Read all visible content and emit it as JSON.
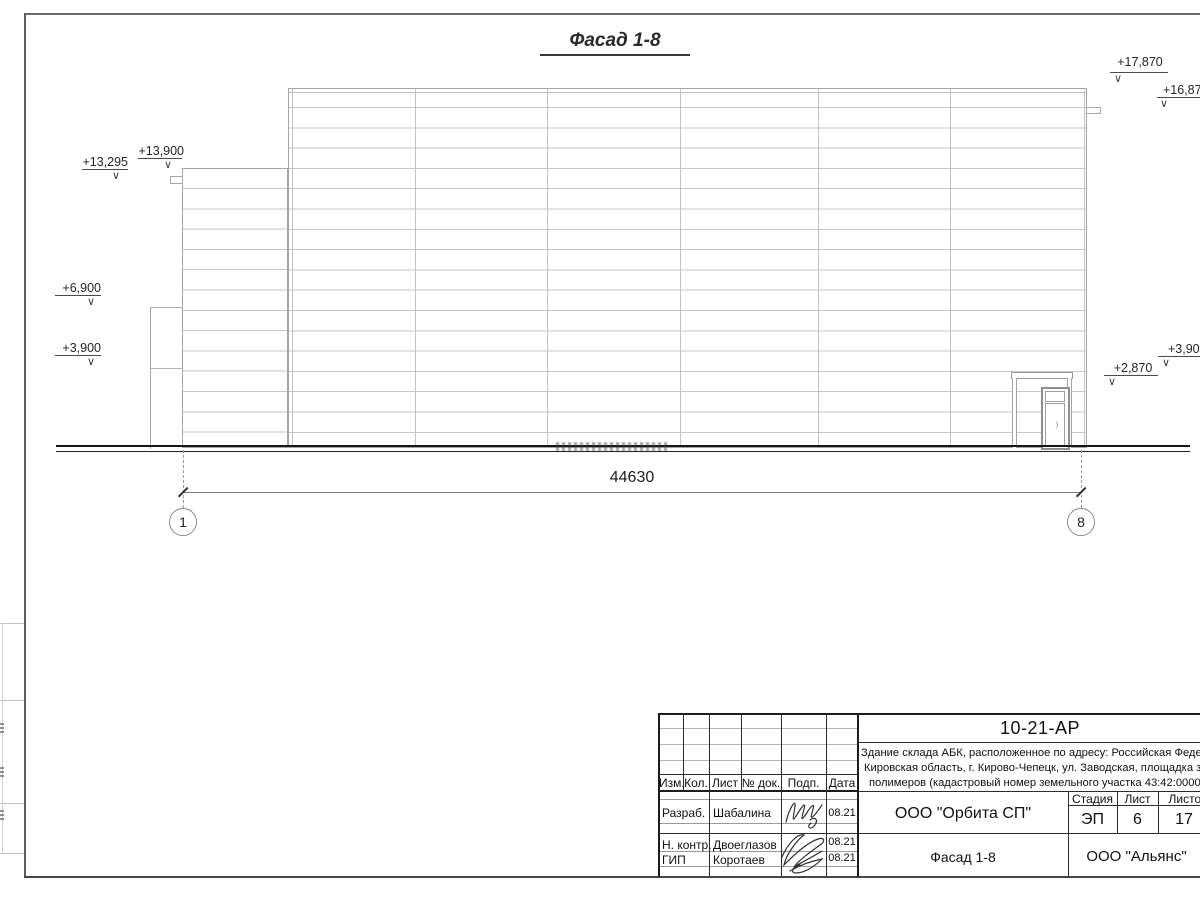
{
  "drawing": {
    "title": "Фасад 1-8",
    "dimension_value": "44630",
    "axis_left": "1",
    "axis_right": "8",
    "elevation_arrow": "∨",
    "elevations": [
      "+13,295",
      "+13,900",
      "+6,900",
      "+3,900",
      "+17,870",
      "+16,870",
      "+3,900",
      "+2,870"
    ]
  },
  "title_block": {
    "doc_number": "10-21-АР",
    "address_line1": "Здание склада АБК, расположенное по адресу: Российская Федерация,",
    "address_line2": "Кировская область, г. Кирово-Чепецк, ул. Заводская, площадка завода",
    "address_line3": "полимеров (кадастровый номер земельного участка 43:42:000022:3",
    "col_izm": "Изм.",
    "col_kol": "Кол.",
    "col_list": "Лист",
    "col_doc": "№ док.",
    "col_podp": "Подп.",
    "col_data": "Дата",
    "row1_role": "Разраб.",
    "row1_name": "Шабалина",
    "row1_date": "08.21",
    "row2_role": "Н. контр.",
    "row2_name": "Двоеглазов",
    "row2_date": "08.21",
    "row3_role": "ГИП",
    "row3_name": "Коротаев",
    "row3_date": "08.21",
    "stage_label": "Стадия",
    "sheet_label": "Лист",
    "sheets_label": "Листов",
    "stage_value": "ЭП",
    "sheet_value": "6",
    "sheets_value": "17",
    "org_design": "ООО \"Орбита СП\"",
    "sheet_title": "Фасад 1-8",
    "org_client": "ООО \"Альянс\""
  }
}
